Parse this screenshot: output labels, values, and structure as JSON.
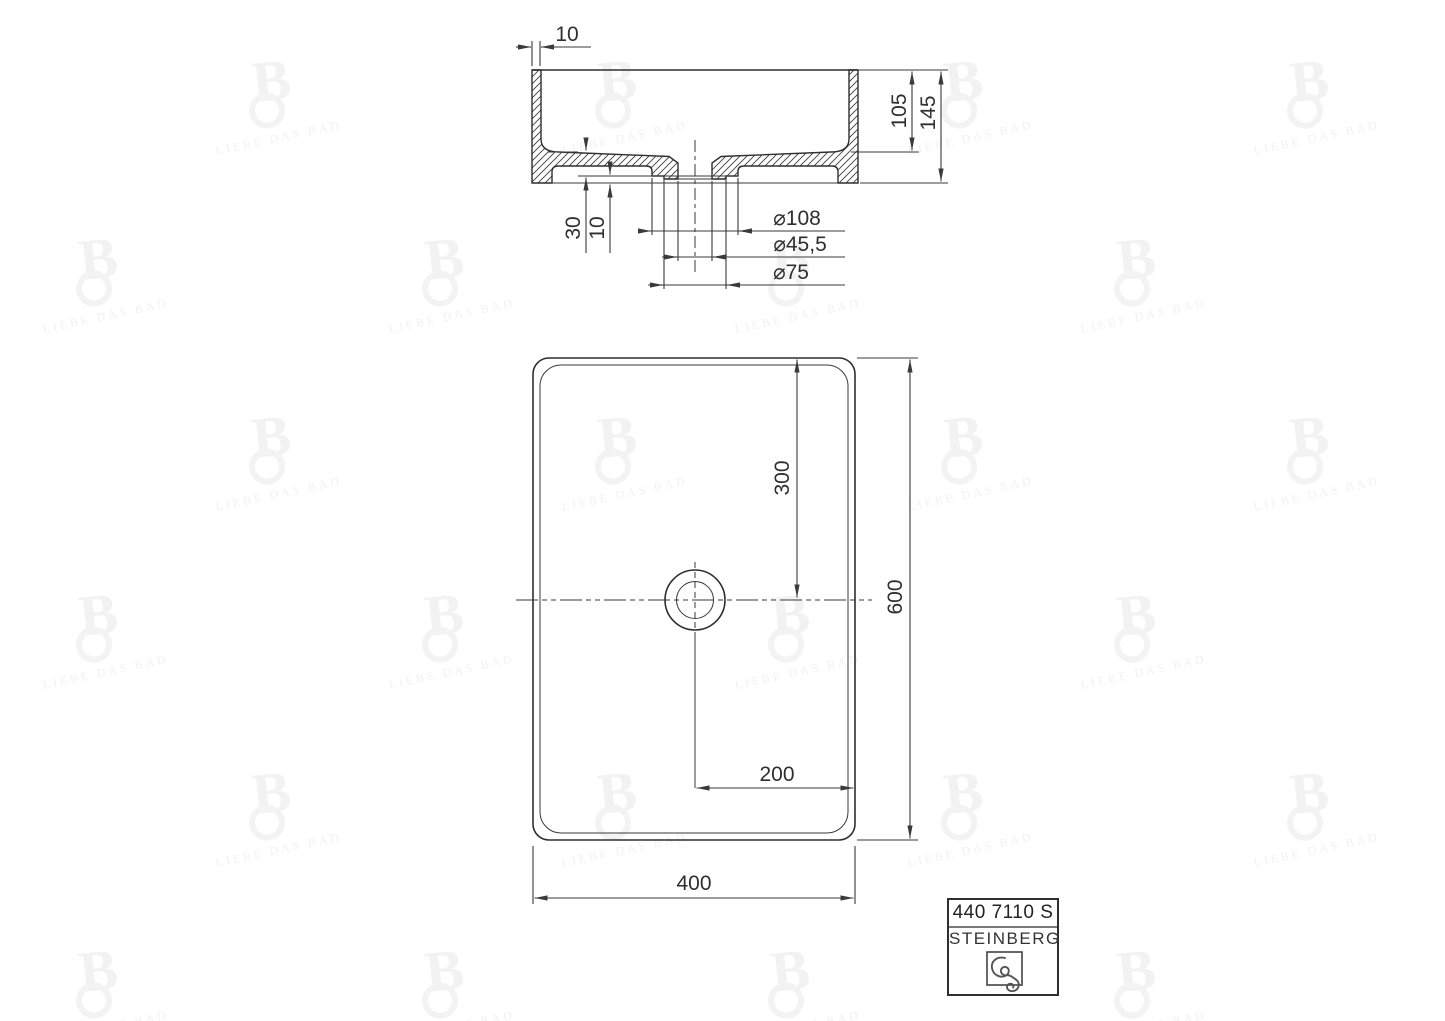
{
  "drawing": {
    "section": {
      "wall_thickness": "10",
      "basin_depth": "105",
      "overall_height": "145",
      "floor_to_recess": "30",
      "recess_to_bottom": "10",
      "dia_recess": "⌀108",
      "dia_drain_hole": "⌀45,5",
      "dia_boss": "⌀75"
    },
    "plan": {
      "drain_from_top": "300",
      "overall_length": "600",
      "drain_from_right": "200",
      "overall_width": "400"
    }
  },
  "title_block": {
    "article_number": "440 7110 S",
    "brand": "STEINBERG"
  },
  "watermark": {
    "monogram": "B",
    "text": "LIEBE DAS BAD"
  },
  "colors": {
    "line": "#3a3a3a",
    "dim_text": "#2f2f2f",
    "watermark": "#f2f2f2"
  }
}
